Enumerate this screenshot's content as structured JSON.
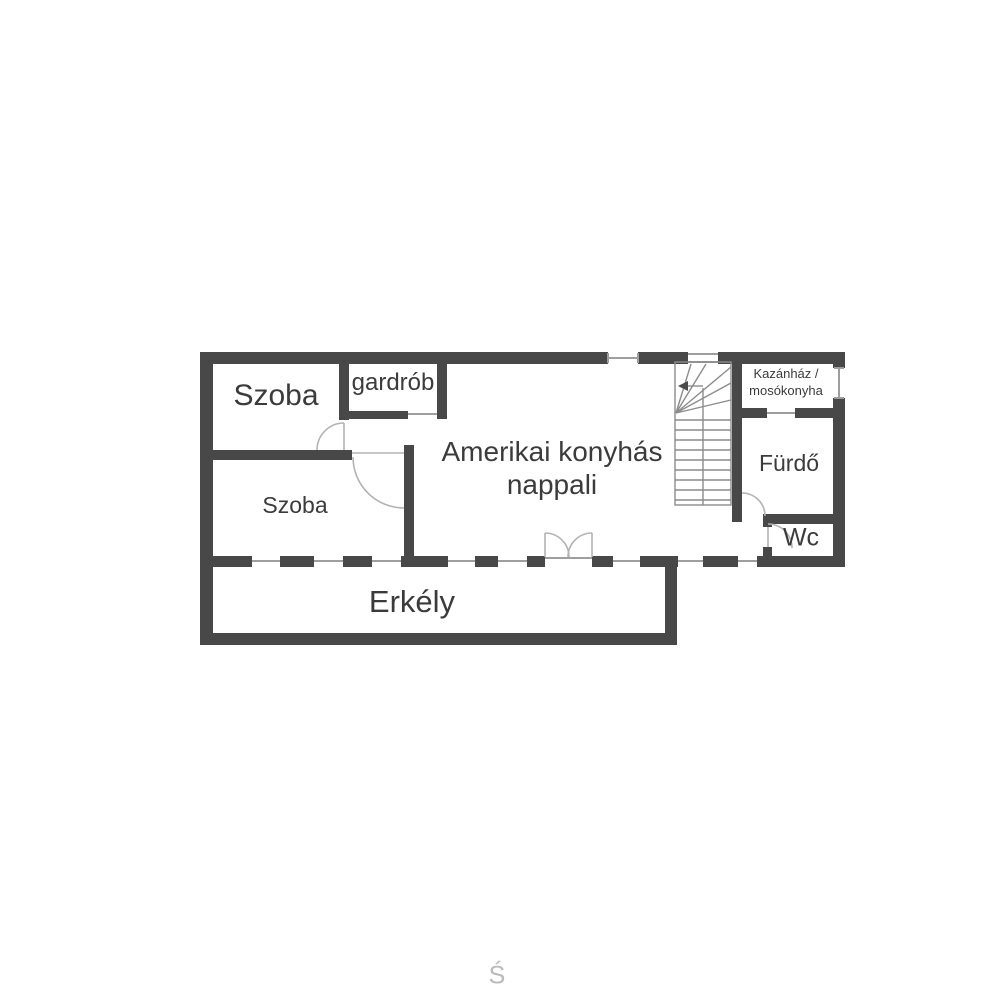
{
  "floorplan": {
    "rooms": {
      "szoba_top": "Szoba",
      "gardrob": "gardrób",
      "szoba_bottom": "Szoba",
      "nappali": {
        "line1": "Amerikai konyhás",
        "line2": "nappali"
      },
      "kazanhaz": {
        "line1": "Kazánház /",
        "line2": "mosókonyha"
      },
      "furdo": "Fürdő",
      "wc": "Wc",
      "erkely": "Erkély"
    },
    "watermark": "Ś",
    "colors": {
      "wall": "#484848",
      "text": "#3b3b3b",
      "thin_line": "#9e9e9e",
      "door_arc": "#b3b3b3",
      "stair_line": "#8c8c8c",
      "watermark": "#b9b9b9",
      "background": "#ffffff"
    }
  }
}
